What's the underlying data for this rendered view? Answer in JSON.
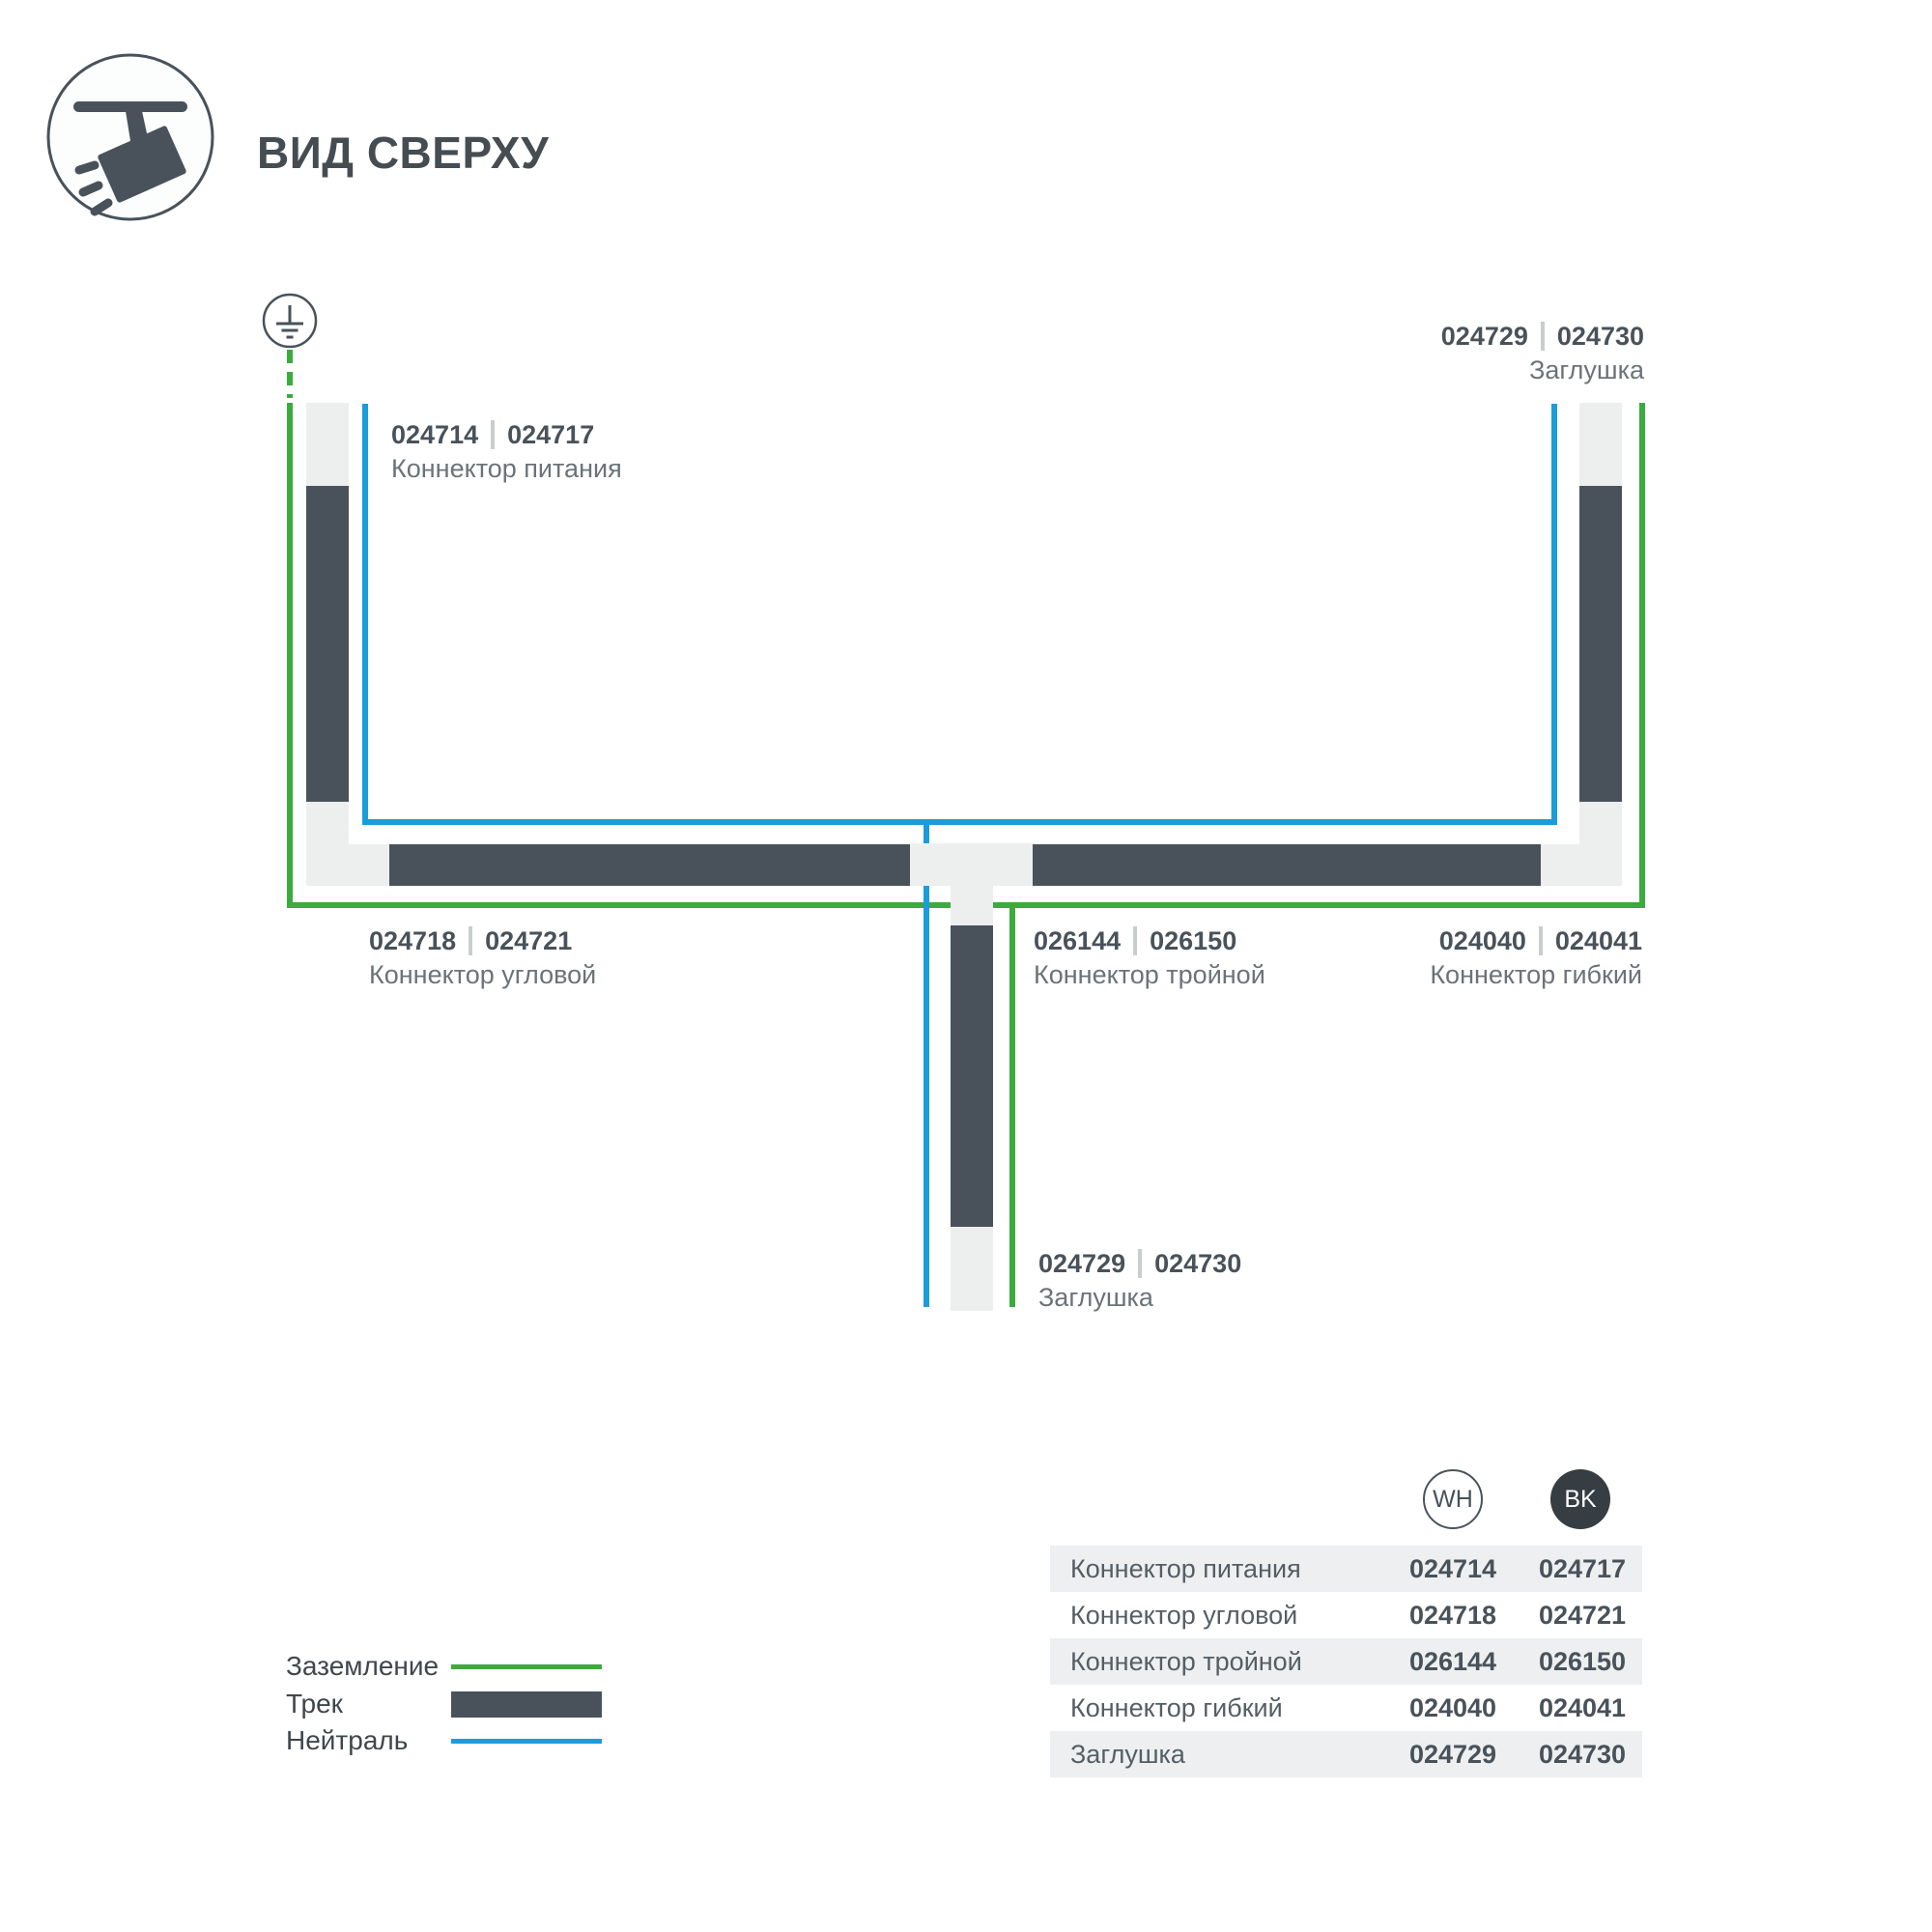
{
  "header": {
    "title": "ВИД СВЕРХУ",
    "icon": "track-spotlight-icon"
  },
  "diagram": {
    "ground_icon": "earth-ground-icon",
    "labels": {
      "power": {
        "code_wh": "024714",
        "code_bk": "024717",
        "name": "Коннектор питания"
      },
      "cap_top": {
        "code_wh": "024729",
        "code_bk": "024730",
        "name": "Заглушка"
      },
      "corner": {
        "code_wh": "024718",
        "code_bk": "024721",
        "name": "Коннектор угловой"
      },
      "triple": {
        "code_wh": "026144",
        "code_bk": "026150",
        "name": "Коннектор тройной"
      },
      "flex": {
        "code_wh": "024040",
        "code_bk": "024041",
        "name": "Коннектор гибкий"
      },
      "cap_bottom": {
        "code_wh": "024729",
        "code_bk": "024730",
        "name": "Заглушка"
      }
    }
  },
  "legend": {
    "ground": "Заземление",
    "track": "Трек",
    "neutral": "Нейтраль"
  },
  "table": {
    "col_wh": "WH",
    "col_bk": "BK",
    "rows": [
      {
        "name": "Коннектор питания",
        "wh": "024714",
        "bk": "024717"
      },
      {
        "name": "Коннектор угловой",
        "wh": "024718",
        "bk": "024721"
      },
      {
        "name": "Коннектор тройной",
        "wh": "026144",
        "bk": "026150"
      },
      {
        "name": "Коннектор гибкий",
        "wh": "024040",
        "bk": "024041"
      },
      {
        "name": "Заглушка",
        "wh": "024729",
        "bk": "024730"
      }
    ]
  },
  "colors": {
    "track_dark": "#49525a",
    "track_light": "#edefef",
    "ground_green": "#3cab3d",
    "neutral_blue": "#1b9dd9",
    "text_dark": "#49525a",
    "text_muted": "#6b7378",
    "separator_gray": "#c9cdcd",
    "table_row_bg": "#edeff0",
    "bk_circle": "#363d43"
  }
}
